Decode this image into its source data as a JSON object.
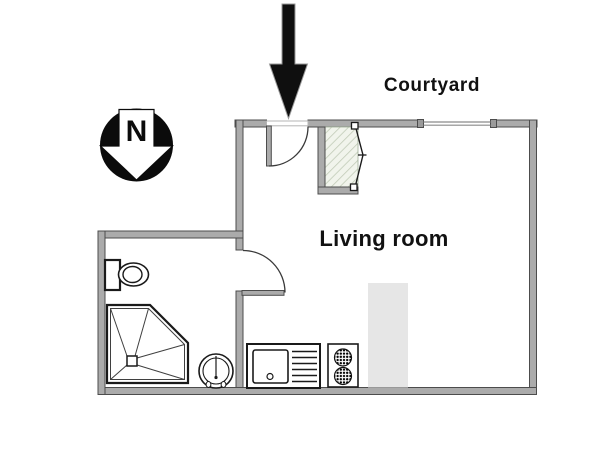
{
  "page": {
    "type": "studio apartment floor plan"
  },
  "labels": {
    "courtyard": "Courtyard",
    "living_room": "Living room",
    "compass_north": "N"
  },
  "colors": {
    "background": "#ffffff",
    "wall_fill": "#ababab",
    "wall_stroke": "#4c4c4c",
    "fixture_stroke": "#1a1a1a",
    "door_arc": "#3a3a3a",
    "window_line": "#8a8a8a",
    "counter_block": "#e6e6e6",
    "hatch_bg": "#f1f4ec",
    "hatch_line": "#c2ccb8",
    "compass": "#0b0b0b",
    "arrow": "#0f0f0f",
    "text": "#111111"
  },
  "fixtures": [
    {
      "id": "entrance-arrow",
      "name": "entrance direction arrow"
    },
    {
      "id": "north-compass",
      "name": "north compass pointing down"
    },
    {
      "id": "entrance-door",
      "name": "entrance door with swing arc"
    },
    {
      "id": "window",
      "name": "window on courtyard wall"
    },
    {
      "id": "closet",
      "name": "closet with bifold doors"
    },
    {
      "id": "interior-door",
      "name": "bathroom door with swing arc"
    },
    {
      "id": "toilet",
      "name": "toilet"
    },
    {
      "id": "shower",
      "name": "corner shower"
    },
    {
      "id": "washbasin",
      "name": "round washbasin"
    },
    {
      "id": "kitchen-sink",
      "name": "kitchen sink with drainboard"
    },
    {
      "id": "stove",
      "name": "two-burner stove"
    },
    {
      "id": "counter-block",
      "name": "counter / fixed block"
    }
  ]
}
